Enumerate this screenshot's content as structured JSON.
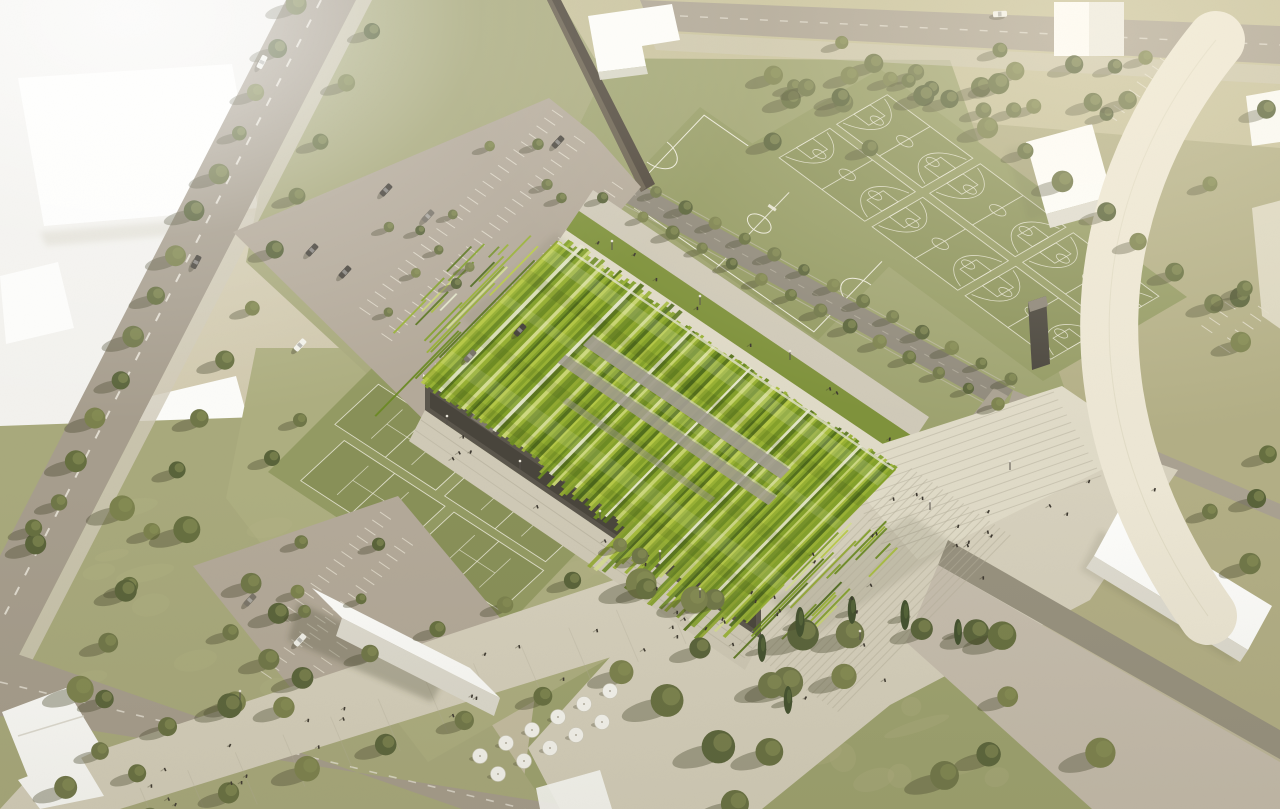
{
  "meta": {
    "title": "Aerial architectural rendering of a sports park with an undulating green-striped ribbon roof hall",
    "type": "architectural-visualization",
    "visible_text": "none"
  },
  "scene": {
    "key_elements": [
      {
        "name": "green-ribbon-roof-hall",
        "desc": "central sports hall, wavy striped green roof with frayed ribbon edges"
      },
      {
        "name": "basketball-courts",
        "count": 6
      },
      {
        "name": "soccer-field",
        "count": 1
      },
      {
        "name": "tennis-courts",
        "count": 4
      },
      {
        "name": "parking-lot-north",
        "desc": "tree lined parking with cars"
      },
      {
        "name": "parking-lot-south",
        "desc": "small parking lot"
      },
      {
        "name": "tree-lined-avenue",
        "desc": "diagonal road separating white massing blocks"
      },
      {
        "name": "plaza-with-steps",
        "desc": "broad paved esplanade and stairs"
      },
      {
        "name": "esplanade-umbrellas",
        "desc": "cafe terrace with white umbrellas"
      },
      {
        "name": "curved-ring-road",
        "desc": "white curved path on the right"
      },
      {
        "name": "white-context-buildings",
        "count": 9
      },
      {
        "name": "trees",
        "desc": "olive green round trees and dark cypresses"
      }
    ],
    "palette": {
      "bg": "#c9c1a6",
      "bg_light": "#ddd6bb",
      "white_zone": "#f2f1ed",
      "slab": "#fdfdfb",
      "slab_shade": "#dedbd0",
      "road": "#a69d8d",
      "road_dash": "#efebe0",
      "street": "#8f897b",
      "top_street": "#aaa191",
      "path": "#a9a191",
      "sidewalk": "#cfc9b8",
      "parking": "#b3a999",
      "parking_line": "#e9e3d4",
      "court_ground": "#939a63",
      "court": "#878f56",
      "court_line": "#eceadb",
      "grass": "#a8a97c",
      "grass_light": "#b2ae85",
      "grass_dark": "#8f9465",
      "grass_warm": "#c6c09a",
      "grass_olive": "#9da26f",
      "plaza": "#d6d0bd",
      "plaza_line": "#b5af9c",
      "step": "#dfdac7",
      "paved_lot": "#c6bdae",
      "dark_road": "#97917f",
      "facade": "#5b564c",
      "facade_dark": "#46423a",
      "canopy": "#edeadf",
      "dark_wall": "#4d453a",
      "roof_greens": [
        "#b8ca49",
        "#98b135",
        "#83a02b",
        "#6b8a24",
        "#5a751f",
        "#c9d574",
        "#a6bc3e",
        "#e3e5c9",
        "#75902a",
        "#91a832",
        "#4e6a1d",
        "#d4dc92"
      ],
      "roof_gray": "#a29c91",
      "roof_pale": "#dcd8cb",
      "tree": "#6f7648",
      "tree_dark": "#59633a",
      "tree_light": "#8b9157",
      "tree_shadow": "rgba(70,72,44,0.38)",
      "cypress": "#42502e",
      "car_dark": "#4a463e",
      "car_gray": "#7a756a",
      "car_white": "#f2f1ea",
      "person": "#3c372f",
      "umbrella": "#f7f6f1",
      "shadow": "rgba(80,76,56,0.30)"
    }
  }
}
